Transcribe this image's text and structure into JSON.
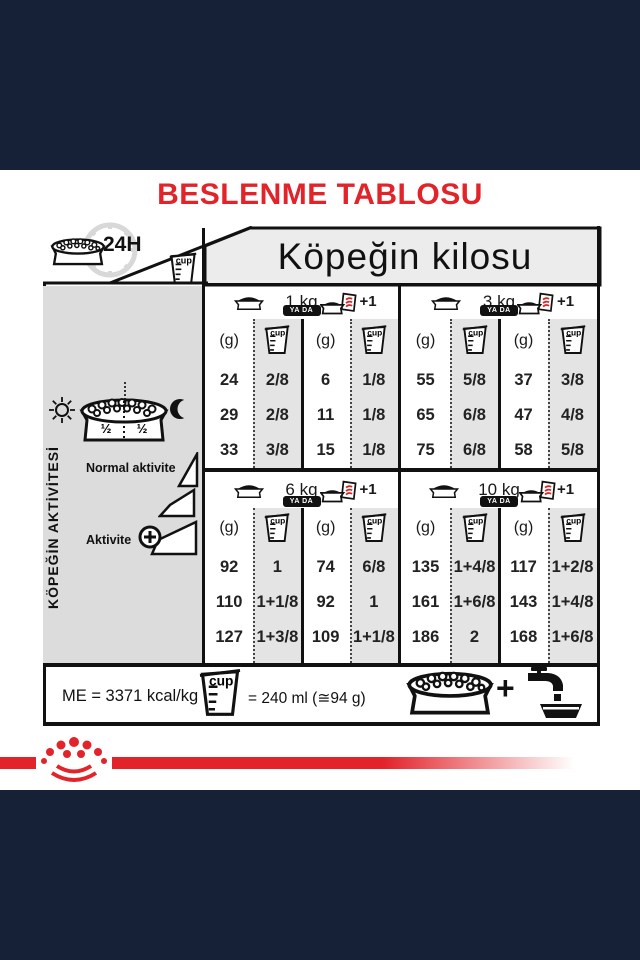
{
  "title": "BESLENME TABLOSU",
  "table": {
    "weight_header": "Köpeğin kilosu",
    "corner": {
      "duration_label": "24H"
    },
    "cup_label": "cup",
    "or_label": "YA DA",
    "plus_one_label": "+1",
    "grams_label": "(g)",
    "groups": [
      {
        "weight": "1 kg",
        "rows": [
          [
            "24",
            "2/8",
            "6",
            "1/8"
          ],
          [
            "29",
            "2/8",
            "11",
            "1/8"
          ],
          [
            "33",
            "3/8",
            "15",
            "1/8"
          ]
        ]
      },
      {
        "weight": "3 kg",
        "rows": [
          [
            "55",
            "5/8",
            "37",
            "3/8"
          ],
          [
            "65",
            "6/8",
            "47",
            "4/8"
          ],
          [
            "75",
            "6/8",
            "58",
            "5/8"
          ]
        ]
      },
      {
        "weight": "6 kg",
        "rows": [
          [
            "92",
            "1",
            "74",
            "6/8"
          ],
          [
            "110",
            "1+1/8",
            "92",
            "1"
          ],
          [
            "127",
            "1+3/8",
            "109",
            "1+1/8"
          ]
        ]
      },
      {
        "weight": "10 kg",
        "rows": [
          [
            "135",
            "1+4/8",
            "117",
            "1+2/8"
          ],
          [
            "161",
            "1+6/8",
            "143",
            "1+4/8"
          ],
          [
            "186",
            "2",
            "168",
            "1+6/8"
          ]
        ]
      }
    ]
  },
  "sidebar": {
    "label": "KÖPEĞİN AKTİVİTESİ",
    "half_left": "½",
    "half_right": "½",
    "normal_activity_label": "Normal aktivite",
    "activity_label": "Aktivite"
  },
  "footer": {
    "me_label": "ME = 3371 kcal/kg",
    "cup_equals_label": "= 240 ml (≅94 g)",
    "plus": "+"
  },
  "colors": {
    "red": "#e2232a",
    "navy": "#162036"
  }
}
